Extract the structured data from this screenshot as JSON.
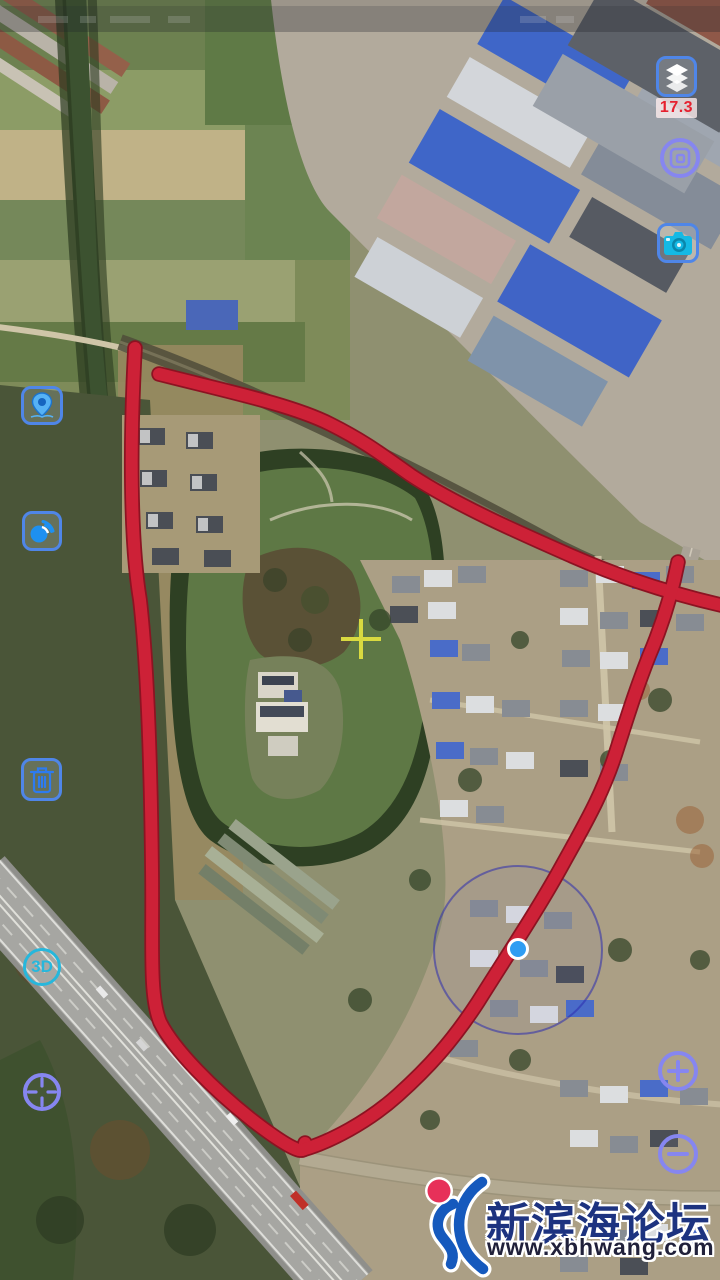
{
  "app": {
    "name": "satellite-map-viewer"
  },
  "zoom_badge": {
    "value": "17.3"
  },
  "view_3d_label": "3D",
  "watermark": {
    "site_name": "新滨海论坛",
    "site_url": "www.xbhwang.com"
  },
  "controls": {
    "right": [
      {
        "name": "layers",
        "icon": "layers-icon"
      },
      {
        "name": "screen-capture",
        "icon": "screen-capture-icon"
      },
      {
        "name": "camera",
        "icon": "camera-icon"
      },
      {
        "name": "zoom-in",
        "icon": "plus-icon"
      },
      {
        "name": "zoom-out",
        "icon": "minus-icon"
      }
    ],
    "left": [
      {
        "name": "location-pin",
        "icon": "location-pin-icon"
      },
      {
        "name": "nearby-radar",
        "icon": "nearby-radar-icon"
      },
      {
        "name": "delete-annotation",
        "icon": "trash-icon"
      },
      {
        "name": "view-3d",
        "icon": "3d-icon"
      },
      {
        "name": "compass-target",
        "icon": "compass-target-icon"
      }
    ]
  },
  "map": {
    "type": "satellite",
    "annotation": {
      "shape": "freehand-red-outline",
      "color": "#cd2137"
    },
    "crosshair_color": "#d9da40",
    "my_location": {
      "dot_color": "#2f9df2",
      "accuracy_circle": true
    }
  },
  "colors": {
    "icon_border_blue": "#4f86e8",
    "icon_purple": "#8686f0",
    "icon_cyan": "#26b7dc",
    "zoom_badge_text": "#e6202f",
    "annotation_red": "#cd2137",
    "crosshair_yellow": "#d9da40",
    "location_blue": "#2f9df2",
    "watermark_navy": "#1d3380"
  }
}
